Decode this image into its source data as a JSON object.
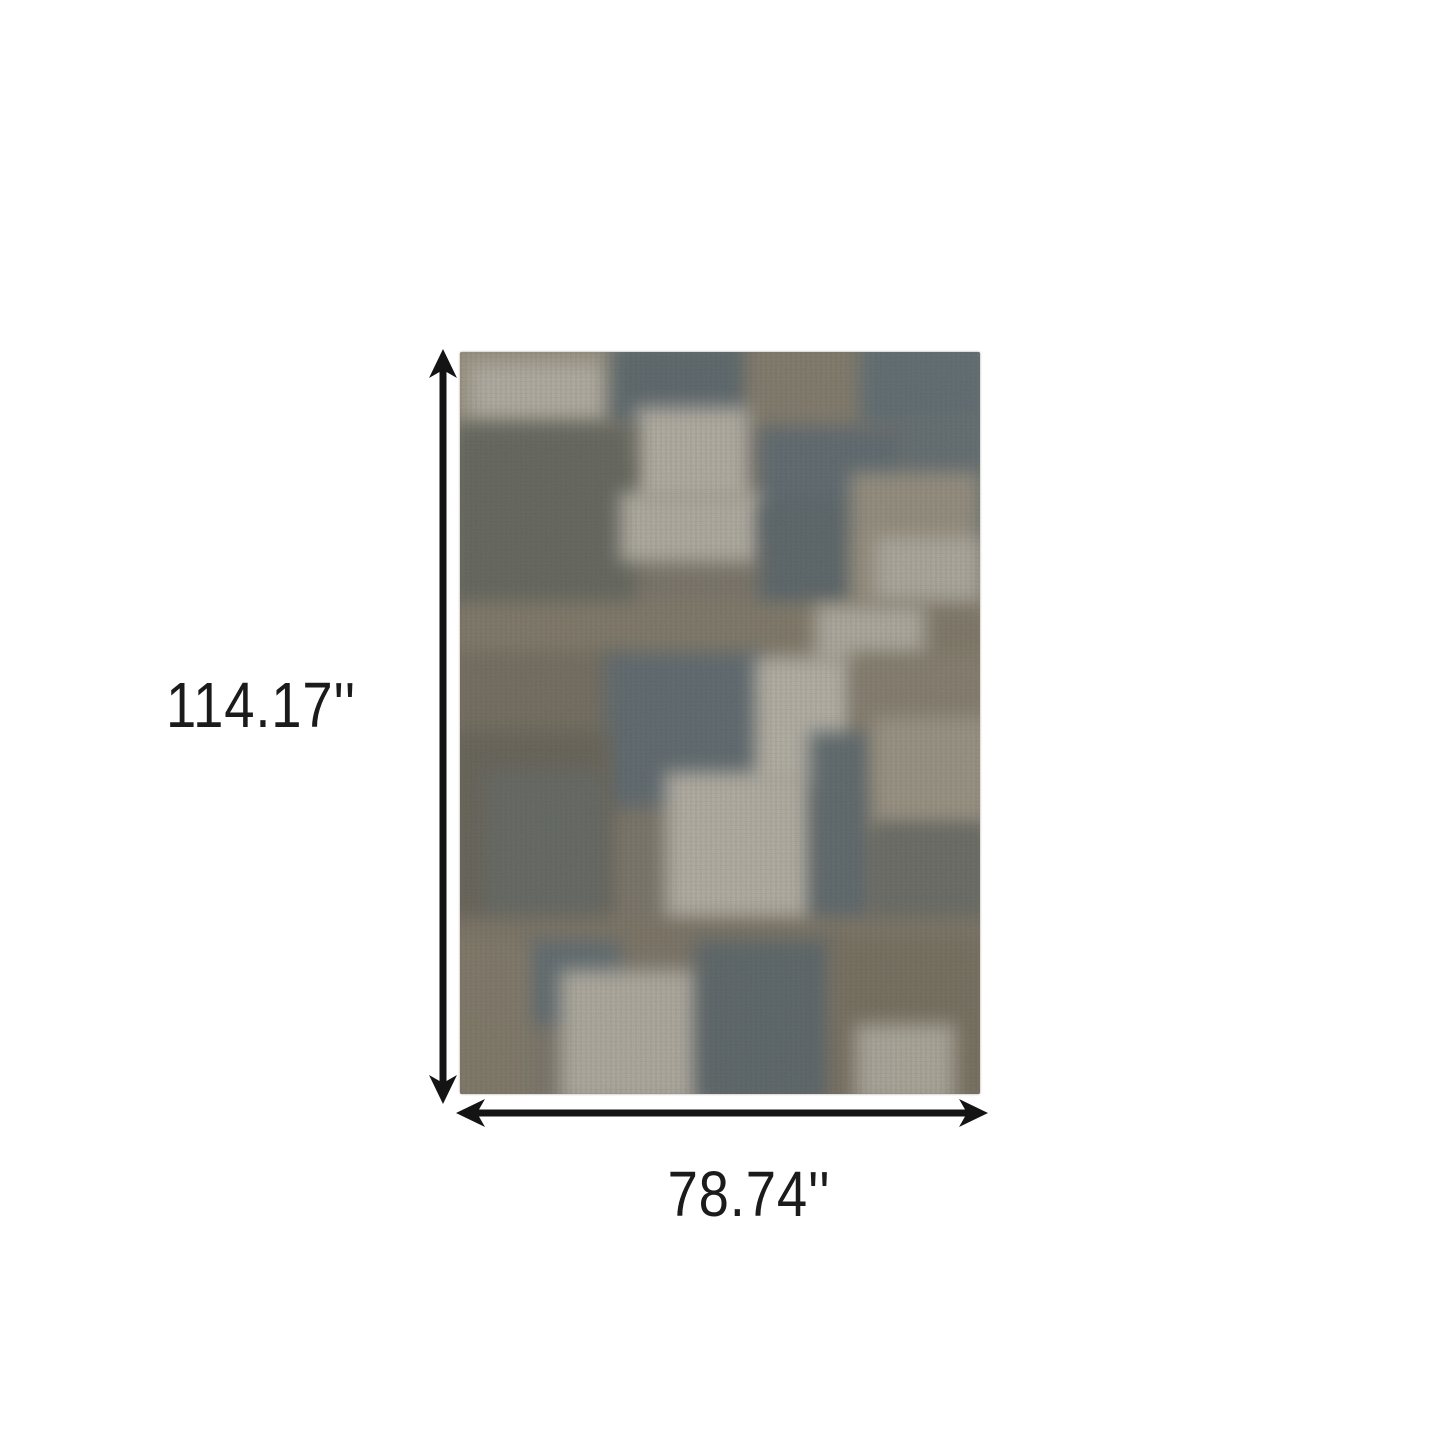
{
  "diagram": {
    "type": "product-dimension-diagram",
    "background_color": "#ffffff",
    "arrow_color": "#141414",
    "label_color": "#1b1b1b",
    "height_label": "114.17''",
    "width_label": "78.74''"
  },
  "rug": {
    "description": "abstract distressed patchwork area rug in slate blue, taupe brown and cream",
    "base_color": "#7a7160",
    "palette": {
      "slate": "#4e616c",
      "dark_slate": "#46585f",
      "taupe": "#877b64",
      "dark_brown": "#5b5545",
      "light_taupe": "#b0a48c",
      "cream": "#d7d0c0"
    },
    "patches": [
      {
        "x": -10,
        "y": -10,
        "w": 185,
        "h": 115,
        "c": "#b1a58c"
      },
      {
        "x": 10,
        "y": 12,
        "w": 135,
        "h": 58,
        "c": "#d7d0c0"
      },
      {
        "x": 150,
        "y": -10,
        "w": 145,
        "h": 85,
        "c": "#485b65"
      },
      {
        "x": 285,
        "y": -10,
        "w": 140,
        "h": 90,
        "c": "#877b64"
      },
      {
        "x": 400,
        "y": -10,
        "w": 130,
        "h": 85,
        "c": "#4e6470"
      },
      {
        "x": 175,
        "y": 55,
        "w": 115,
        "h": 95,
        "c": "#d8d1c1"
      },
      {
        "x": 300,
        "y": 75,
        "w": 150,
        "h": 110,
        "c": "#4b5f6b"
      },
      {
        "x": 440,
        "y": 60,
        "w": 90,
        "h": 140,
        "c": "#53656d"
      },
      {
        "x": -10,
        "y": 70,
        "w": 185,
        "h": 230,
        "c": "#575b4e",
        "streak": true
      },
      {
        "x": 160,
        "y": 140,
        "w": 140,
        "h": 70,
        "c": "#d5cfbf"
      },
      {
        "x": 300,
        "y": 150,
        "w": 95,
        "h": 115,
        "c": "#465860"
      },
      {
        "x": 390,
        "y": 120,
        "w": 130,
        "h": 145,
        "c": "#a89c84"
      },
      {
        "x": 415,
        "y": 185,
        "w": 105,
        "h": 80,
        "c": "#cfc9b8"
      },
      {
        "x": -10,
        "y": 250,
        "w": 540,
        "h": 65,
        "c": "#84785f"
      },
      {
        "x": 355,
        "y": 253,
        "w": 110,
        "h": 58,
        "c": "#d2cbba"
      },
      {
        "x": -10,
        "y": 300,
        "w": 170,
        "h": 160,
        "c": "#6e654f"
      },
      {
        "x": 145,
        "y": 300,
        "w": 160,
        "h": 155,
        "c": "#4c5e69"
      },
      {
        "x": 295,
        "y": 305,
        "w": 100,
        "h": 130,
        "c": "#dcd6c6"
      },
      {
        "x": 390,
        "y": 300,
        "w": 140,
        "h": 140,
        "c": "#8d8169"
      },
      {
        "x": -10,
        "y": 380,
        "w": 160,
        "h": 200,
        "c": "#5b5545",
        "streak": true
      },
      {
        "x": 205,
        "y": 420,
        "w": 150,
        "h": 160,
        "c": "#dad3c3"
      },
      {
        "x": 350,
        "y": 380,
        "w": 62,
        "h": 195,
        "c": "#4b5d66"
      },
      {
        "x": 25,
        "y": 420,
        "w": 120,
        "h": 150,
        "c": "#565d55"
      },
      {
        "x": 412,
        "y": 365,
        "w": 118,
        "h": 115,
        "c": "#b0a48c"
      },
      {
        "x": 410,
        "y": 470,
        "w": 120,
        "h": 110,
        "c": "#5e6258"
      },
      {
        "x": -10,
        "y": 565,
        "w": 540,
        "h": 45,
        "c": "#7c705a"
      },
      {
        "x": 65,
        "y": 588,
        "w": 95,
        "h": 85,
        "c": "#50626b"
      },
      {
        "x": 100,
        "y": 618,
        "w": 145,
        "h": 134,
        "c": "#d3ccbb"
      },
      {
        "x": 235,
        "y": 588,
        "w": 138,
        "h": 164,
        "c": "#47585f"
      },
      {
        "x": 370,
        "y": 588,
        "w": 160,
        "h": 164,
        "c": "#74684f"
      },
      {
        "x": 395,
        "y": 672,
        "w": 100,
        "h": 80,
        "c": "#ccc5b3"
      },
      {
        "x": -10,
        "y": 588,
        "w": 80,
        "h": 164,
        "c": "#84785f"
      }
    ]
  }
}
